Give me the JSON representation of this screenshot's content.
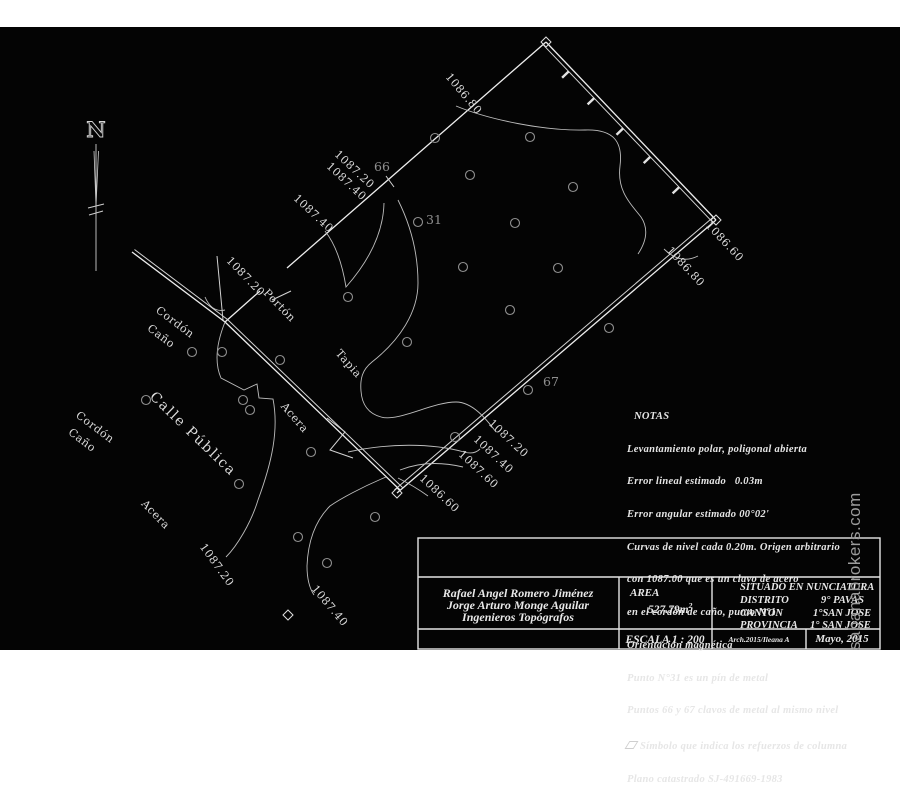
{
  "compass": {
    "north": "N"
  },
  "watermark": {
    "text": "sabanabrokers.com"
  },
  "map": {
    "points": {
      "p31": "31",
      "p66": "66",
      "p67": "67"
    },
    "elev_top": "1086.80",
    "elev_ne1": "1087.20",
    "elev_ne2": "1087.40",
    "elev_ne3": "1087.40",
    "elev_gate": "1087.20",
    "gate": "Portón",
    "cordon_upper1": "Cordón",
    "cordon_upper2": "Caño",
    "tapia": "Tapia",
    "acera_mid": "Acera",
    "calle": "Calle Pública",
    "cordon_lower1": "Cordón",
    "cordon_lower2": "Caño",
    "acera_lower": "Acera",
    "elev_sw1": "1087.20",
    "elev_sw2": "1087.40",
    "elev_se1": "1087.20",
    "elev_se2": "1087.40",
    "elev_se3": "1087.60",
    "elev_se4": "1086.60",
    "elev_e1": "1086.60",
    "elev_e2": "1086.80"
  },
  "notes": {
    "title": "NOTAS",
    "lines": [
      "Levantamiento polar, poligonal abierta",
      "Error lineal estimado   0.03m",
      "Error angular estimado 00°02'",
      "Curvas de nivel cada 0.20m. Origen arbitrario",
      "con 1087.00 que es un clavo de acero",
      "en el cordón de caño, punto N°1",
      "Orientación magnética",
      "Punto N°31 es un pín de metal",
      "Puntos 66 y 67 clavos de metal al mismo nivel",
      "Símbolo que indica los refuerzos de columna",
      "Plano catastrado SJ-491669-1983"
    ]
  },
  "title_block": {
    "surveyor1": "Rafael Angel Romero Jiménez",
    "surveyor2": "Jorge Arturo Monge Aguilar",
    "surveyor3": "Ingenieros Topógrafos",
    "area_label": "AREA",
    "area_value": "527.79m",
    "area_sup": "2",
    "situado_label": "SITUADO EN",
    "situado_value": "NUNCIATURA",
    "distrito_label": "DISTRITO",
    "distrito_value": "9° PAVAS",
    "canton_label": "CANTON",
    "canton_value": "1°SAN JOSE",
    "provincia_label": "PROVINCIA",
    "provincia_value": "1° SAN JOSE",
    "escala": "ESCALA 1 : 200",
    "archivo": "Arch.2015/Ileana A",
    "fecha": "Mayo, 2015"
  }
}
